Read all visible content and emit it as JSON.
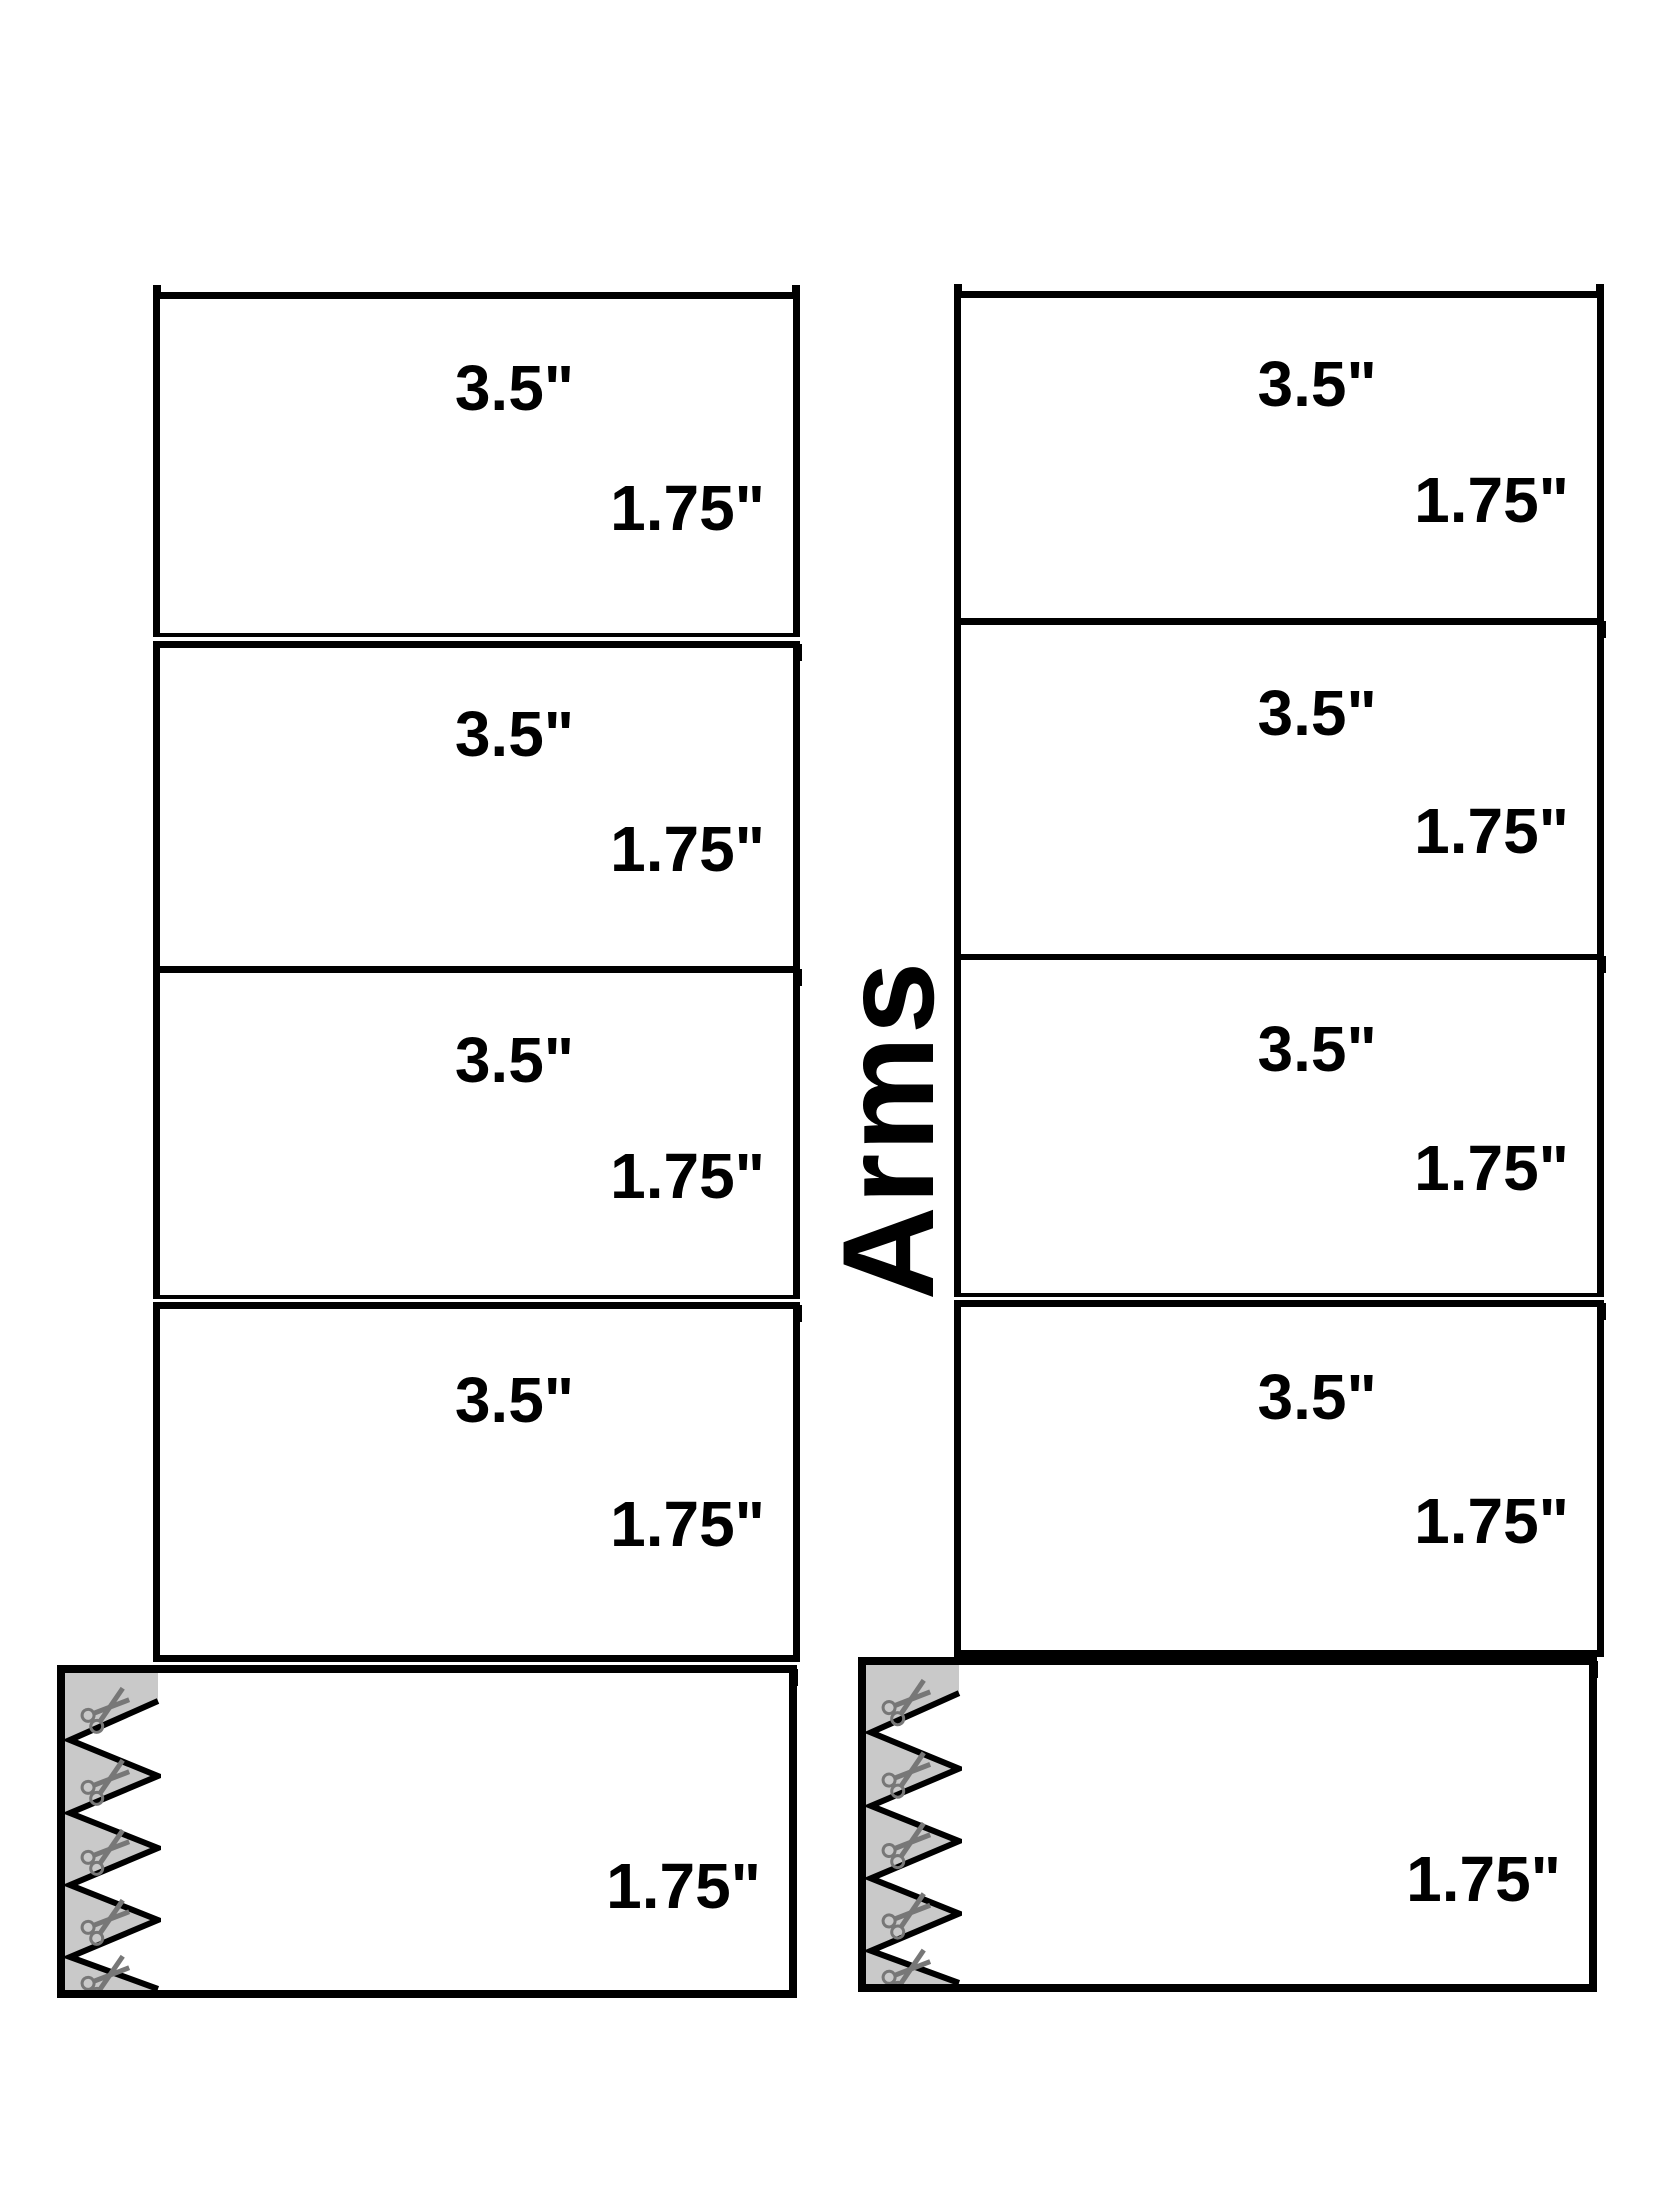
{
  "sheet": {
    "center_label": "Arms"
  },
  "columns": {
    "left": {
      "pieces": [
        {
          "width_label": "3.5\"",
          "height_label": "1.75\""
        },
        {
          "width_label": "3.5\"",
          "height_label": "1.75\""
        },
        {
          "width_label": "3.5\"",
          "height_label": "1.75\""
        },
        {
          "width_label": "3.5\"",
          "height_label": "1.75\""
        },
        {
          "height_label": "1.75\""
        }
      ]
    },
    "right": {
      "pieces": [
        {
          "width_label": "3.5\"",
          "height_label": "1.75\""
        },
        {
          "width_label": "3.5\"",
          "height_label": "1.75\""
        },
        {
          "width_label": "3.5\"",
          "height_label": "1.75\""
        },
        {
          "width_label": "3.5\"",
          "height_label": "1.75\""
        },
        {
          "height_label": "1.75\""
        }
      ]
    }
  },
  "icons": {
    "scissors": "scissors-icon"
  },
  "colors": {
    "line": "#000000",
    "background": "#ffffff",
    "cut_strip_fill": "#c9c9c9",
    "scissors_gray": "#777777"
  }
}
